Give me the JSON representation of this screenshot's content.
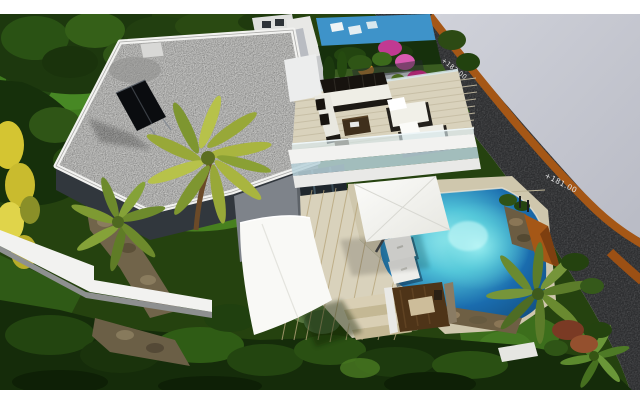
{
  "scene": {
    "description": "Aerial 3D architectural rendering of a modern white villa: flat gravel roof with solar panels, roof terrace with outdoor lounge furniture, glass railings, infinity pool with sun loungers, white cantilever parasol and shade sail, landscaped gardens with palm trees, and a curved road with dark rock embankment and terracotta curb on the right",
    "road_markings": {
      "upper": "+182.00",
      "lower": "+181.00"
    },
    "colors": {
      "letterbox": "#ffffff",
      "terrain": "#d0d2da",
      "road": "#2d2e30",
      "curb": "#a55716",
      "garden": "#25420f",
      "lawn": "#47801f",
      "roof_gravel": "#c3c3c1",
      "parapet": "#f2f2f0",
      "facade_shadow": "#31373d",
      "wall_gray": "#7e838a",
      "deck_wood": "#d9d2bc",
      "pool_deep": "#1a6cae",
      "pool_glow": "#9ff0f2",
      "sail": "#f9f9f6",
      "solar_panel": "#0a0c0f",
      "stone": "#71644a",
      "sunken_wood": "#4e3418",
      "flower_pink": "#c13a92",
      "flower_yellow": "#d4c532",
      "palm_frond": "#a9b53f",
      "neighbor_pool": "#3e93c9",
      "label_text": "#e3e3e3"
    }
  }
}
